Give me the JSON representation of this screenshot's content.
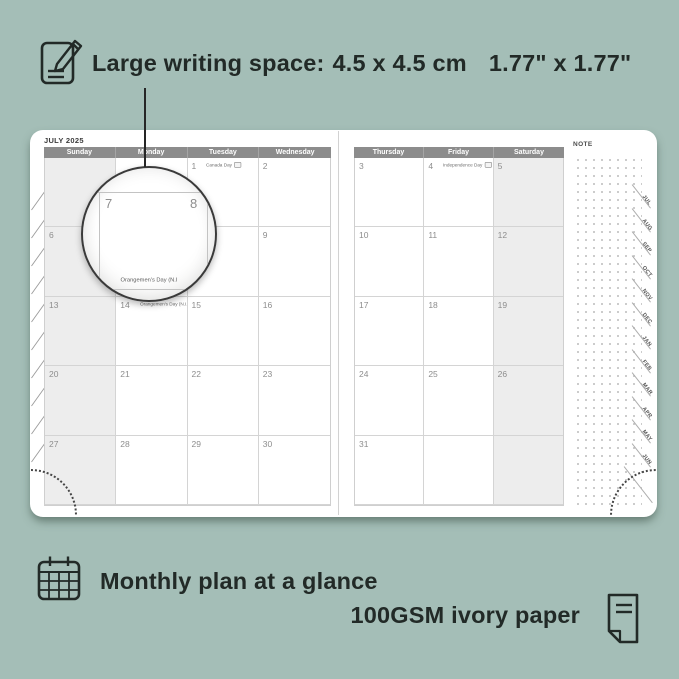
{
  "colors": {
    "background": "#a4beb7",
    "page": "#ffffff",
    "header_bar": "#8c8c8c",
    "weekend_shade": "#ededed",
    "grid_line": "#d4d4d4",
    "ink": "#222a27"
  },
  "top_annotation": {
    "icon": "pencil-note-icon",
    "label": "Large writing space:",
    "metric": "4.5 x 4.5 cm",
    "imperial": "1.77\" x 1.77\""
  },
  "planner": {
    "left_page": {
      "title": "JULY 2025",
      "day_headers": [
        "Sunday",
        "Monday",
        "Tuesday",
        "Wednesday"
      ],
      "shaded_column": 0,
      "weeks": [
        [
          {
            "d": ""
          },
          {
            "d": ""
          },
          {
            "d": "1",
            "h": "Canada Day",
            "badge": true
          },
          {
            "d": "2"
          }
        ],
        [
          {
            "d": "6"
          },
          {
            "d": "7"
          },
          {
            "d": "8"
          },
          {
            "d": "9"
          }
        ],
        [
          {
            "d": "13"
          },
          {
            "d": "14",
            "h": "Orangemen's Day (N.I.)",
            "badge": true
          },
          {
            "d": "15"
          },
          {
            "d": "16"
          }
        ],
        [
          {
            "d": "20"
          },
          {
            "d": "21"
          },
          {
            "d": "22"
          },
          {
            "d": "23"
          }
        ],
        [
          {
            "d": "27"
          },
          {
            "d": "28"
          },
          {
            "d": "29"
          },
          {
            "d": "30"
          }
        ]
      ]
    },
    "right_page": {
      "day_headers": [
        "Thursday",
        "Friday",
        "Saturday"
      ],
      "shaded_column": 2,
      "weeks": [
        [
          {
            "d": "3"
          },
          {
            "d": "4",
            "h": "Independence Day",
            "badge": true
          },
          {
            "d": "5"
          }
        ],
        [
          {
            "d": "10"
          },
          {
            "d": "11"
          },
          {
            "d": "12"
          }
        ],
        [
          {
            "d": "17"
          },
          {
            "d": "18"
          },
          {
            "d": "19"
          }
        ],
        [
          {
            "d": "24"
          },
          {
            "d": "25"
          },
          {
            "d": "26"
          }
        ],
        [
          {
            "d": "31"
          },
          {
            "d": ""
          },
          {
            "d": ""
          }
        ]
      ]
    },
    "note_label": "NOTE",
    "month_tabs": [
      "JUL",
      "AUG",
      "SEP",
      "OCT",
      "NOV",
      "DEC",
      "JAN",
      "FEB",
      "MAR",
      "APR",
      "MAY",
      "JUN"
    ]
  },
  "magnifier": {
    "left_date": "7",
    "right_date": "8",
    "caption": "Orangemen's Day (N.I"
  },
  "bottom_annotations": {
    "calendar_icon": "monthly-calendar-icon",
    "line1": "Monthly plan at a glance",
    "line2": "100GSM ivory paper",
    "paper_icon": "paper-sheet-icon"
  }
}
